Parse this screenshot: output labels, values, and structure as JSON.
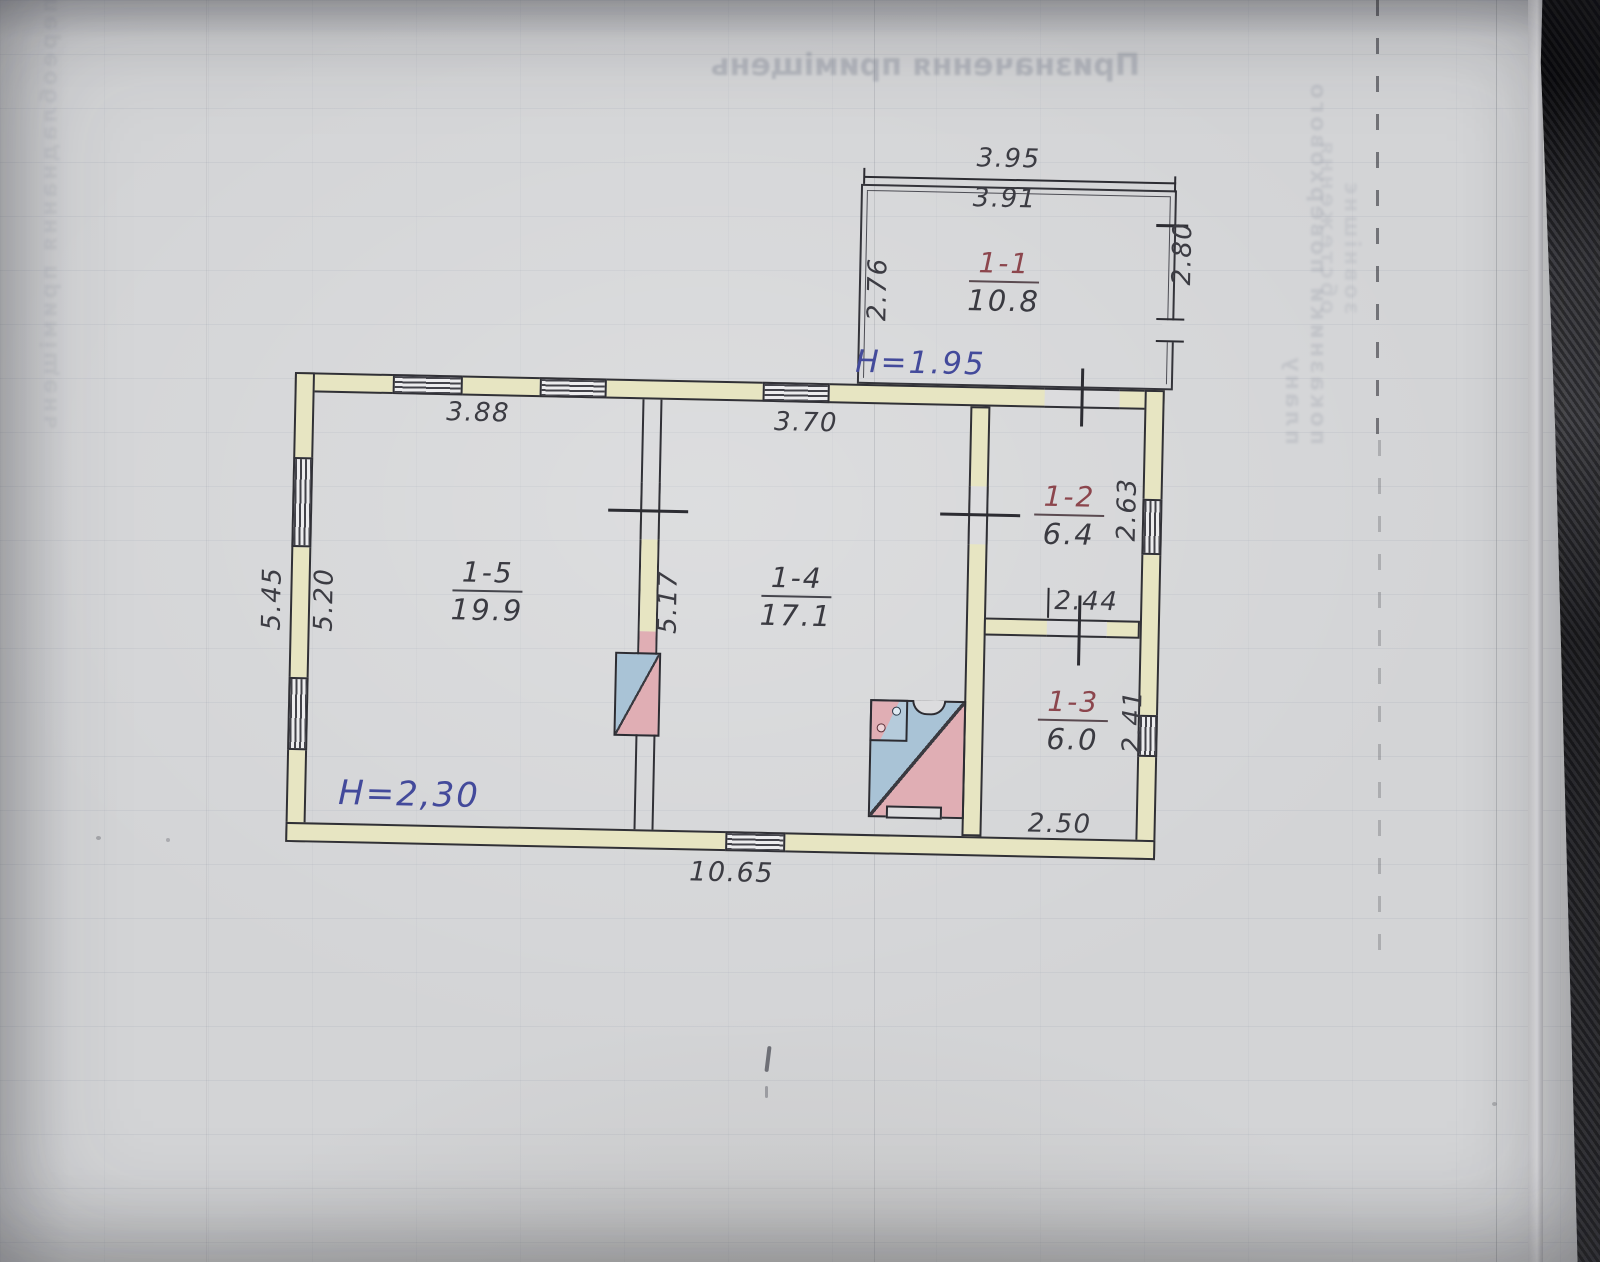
{
  "photo": {
    "bleedthrough": {
      "title": "Призначення приміщень",
      "left_column": "переобладнання приміщень",
      "right_column_a": "показники поверхового плану",
      "right_column_b": "зовнішнє обстеження"
    },
    "colors": {
      "paper": "#d3d4d6",
      "wall_fill": "#e7e5c2",
      "pencil": "#3c3c43",
      "ink_blue": "#434a9b",
      "room_number_red": "#8c464d",
      "stove_blue": "#a9c3d6",
      "stove_pink": "#e0aeb4"
    }
  },
  "plan": {
    "rooms": {
      "r11": {
        "number": "1-1",
        "area": "10.8"
      },
      "r12": {
        "number": "1-2",
        "area": "6.4"
      },
      "r13": {
        "number": "1-3",
        "area": "6.0"
      },
      "r14": {
        "number": "1-4",
        "area": "17.1"
      },
      "r15": {
        "number": "1-5",
        "area": "19.9"
      }
    },
    "heights": {
      "annex": "H=1.95",
      "main": "H=2,30"
    },
    "dims": {
      "annex_top_outer": "3.95",
      "annex_top_inner": "3.91",
      "annex_left": "2.76",
      "annex_right": "2.80",
      "top_room15": "3.88",
      "top_room14": "3.70",
      "left_outer": "5.45",
      "left_inner": "5.20",
      "wall_15_14": "5.17",
      "r12_width": "2.44",
      "r12_depth": "2.63",
      "r13_width": "2.50",
      "r13_depth": "2.41",
      "bottom_total": "10.65"
    }
  }
}
